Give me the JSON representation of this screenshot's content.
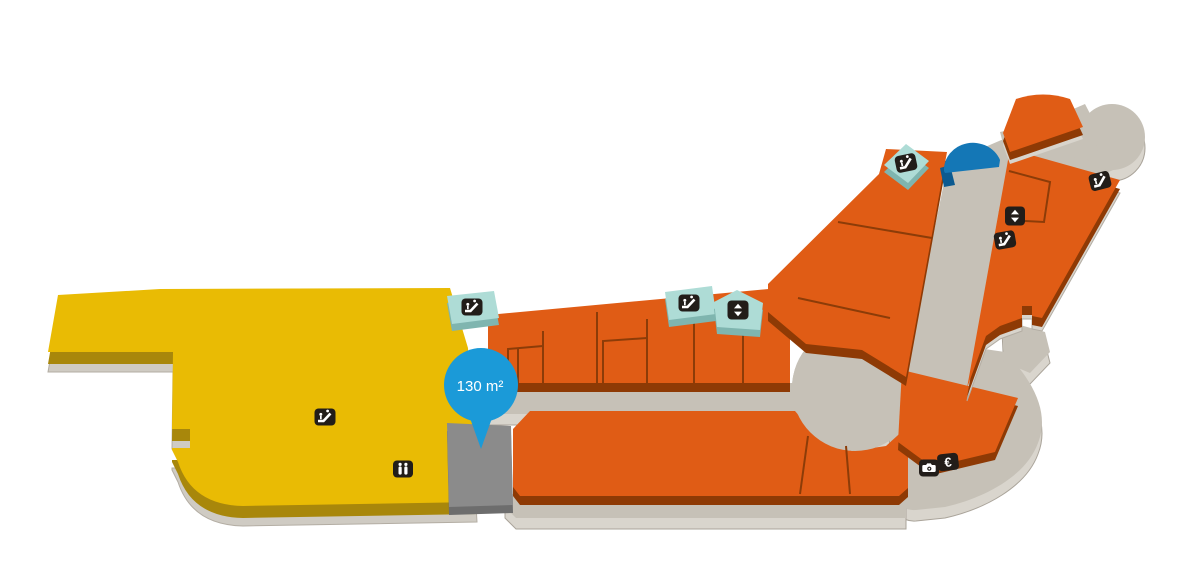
{
  "map": {
    "title": "mall-floorplan",
    "pin": {
      "label": "130 m²",
      "color": "#1b9ad8",
      "text_color": "#ffffff"
    },
    "icons": {
      "euro_glyph": "€",
      "names": [
        "escalator-icon",
        "elevator-icon",
        "toilets-icon",
        "camera-icon",
        "euro-icon"
      ]
    },
    "colors": {
      "anchor_store": "#e9bb04",
      "anchor_store_side": "#a8870b",
      "shop_unit": "#e05c15",
      "shop_unit_side": "#8e3a05",
      "walkway": "#c6c1b7",
      "walkway_base": "#d9d5cd",
      "vacant_unit": "#8b8b8b",
      "vacant_unit_side": "#6d6d6d",
      "amenity_tile": "#aedcd6",
      "amenity_tile_side": "#7fb5af",
      "dome": "#1477b6",
      "icon_badge": "#221d19"
    }
  }
}
